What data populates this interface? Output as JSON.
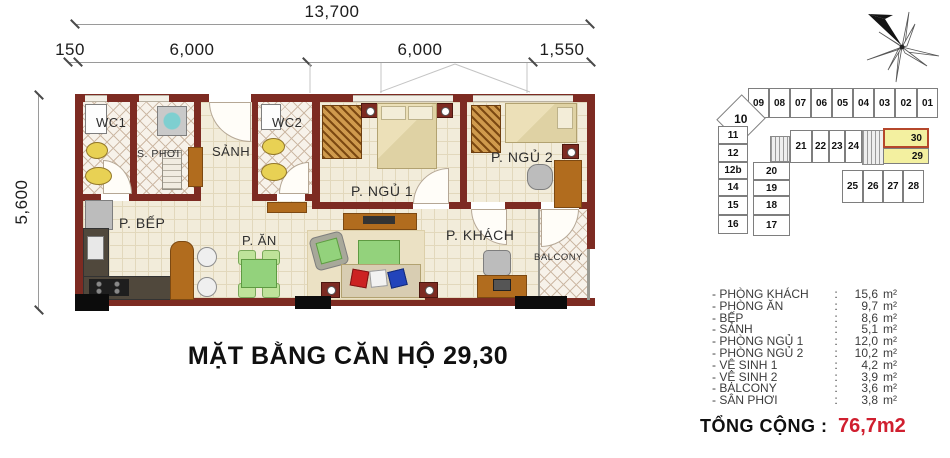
{
  "title": "MẶT BẰNG CĂN HỘ 29,30",
  "dimensions": {
    "total": "13,700",
    "seg1": "150",
    "seg2": "6,000",
    "seg3": "6,000",
    "seg4": "1,550",
    "height": "5,600"
  },
  "plan": {
    "rooms": {
      "wc1": "WC1",
      "sphoi": "S. PHƠI",
      "sanh": "SẢNH",
      "wc2": "WC2",
      "bep": "P. BẾP",
      "an": "P. ĂN",
      "ngu1": "P. NGỦ 1",
      "ngu2": "P. NGỦ 2",
      "khach": "P. KHÁCH",
      "balcony": "BALCONY"
    }
  },
  "keyplan": {
    "units": [
      "01",
      "02",
      "03",
      "04",
      "05",
      "06",
      "07",
      "08",
      "09",
      "10",
      "11",
      "12",
      "12b",
      "14",
      "15",
      "16",
      "17",
      "18",
      "19",
      "20",
      "21",
      "22",
      "23",
      "24",
      "25",
      "26",
      "27",
      "28",
      "29",
      "30"
    ],
    "highlighted": [
      "30",
      "29"
    ]
  },
  "areas": {
    "dash": "-",
    "colon": ":",
    "unit": "m²",
    "items": [
      {
        "name": "PHÒNG KHÁCH",
        "value": "15,6"
      },
      {
        "name": "PHÒNG ĂN",
        "value": "9,7"
      },
      {
        "name": "BẾP",
        "value": "8,6"
      },
      {
        "name": "SẢNH",
        "value": "5,1"
      },
      {
        "name": "PHÒNG NGỦ 1",
        "value": "12,0"
      },
      {
        "name": "PHÒNG NGỦ 2",
        "value": "10,2"
      },
      {
        "name": "VỆ SINH 1",
        "value": "4,2"
      },
      {
        "name": "VỆ SINH 2",
        "value": "3,9"
      },
      {
        "name": "BALCONY",
        "value": "3,6"
      },
      {
        "name": "SÂN PHƠI",
        "value": "3,8"
      }
    ],
    "total_label": "TỔNG CỘNG",
    "total_colon": ":",
    "total_value": "76,7m2"
  },
  "colors": {
    "wall": "#7d2b22",
    "floor": "#f2ecda",
    "highlight_unit": "#f3f0a0",
    "unit30_border": "#b5472b",
    "total_accent": "#d01f2f"
  }
}
